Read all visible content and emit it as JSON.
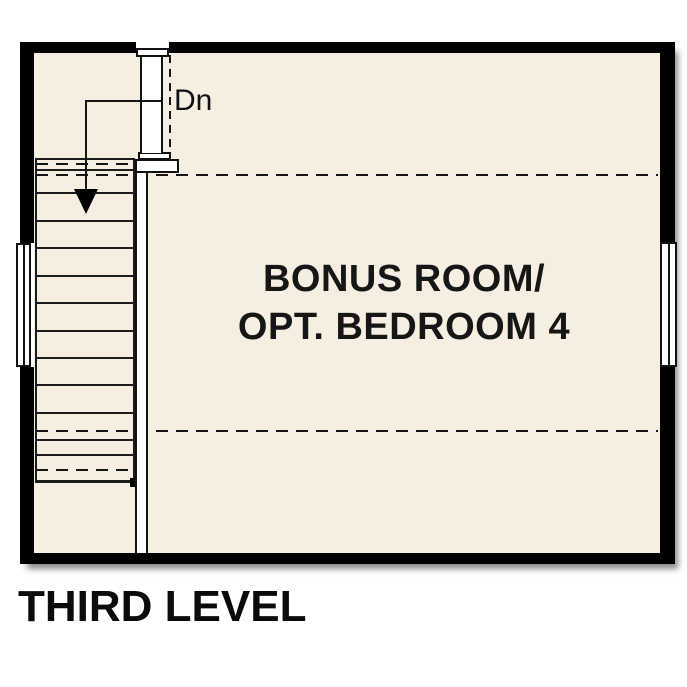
{
  "plan": {
    "title": "THIRD LEVEL",
    "room": {
      "label_line1": "BONUS ROOM/",
      "label_line2": "OPT. BEDROOM 4"
    },
    "stairs": {
      "direction_label": "Dn",
      "tread_count": 12
    },
    "windows": [
      "left-wall-window",
      "right-wall-window"
    ],
    "colors": {
      "wall": "#000000",
      "floor": "#f5eee1",
      "fixture_white": "#ffffff",
      "line": "#1c1c1c"
    }
  }
}
